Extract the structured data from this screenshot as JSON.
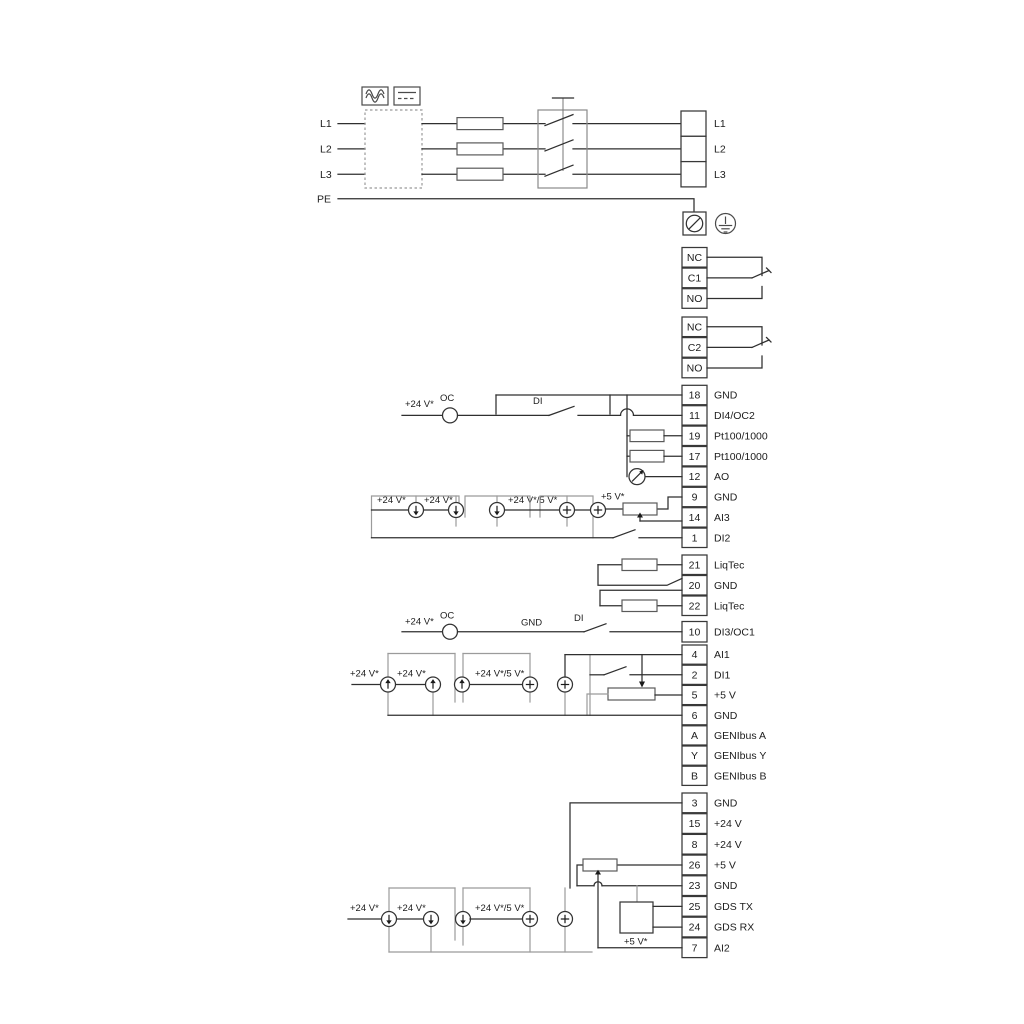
{
  "power": {
    "in": [
      "L1",
      "L2",
      "L3",
      "PE"
    ],
    "out": [
      "L1",
      "L2",
      "L3"
    ]
  },
  "relay1": [
    "NC",
    "C1",
    "NO"
  ],
  "relay2": [
    "NC",
    "C2",
    "NO"
  ],
  "io1": [
    {
      "n": "18",
      "l": "GND"
    },
    {
      "n": "11",
      "l": "DI4/OC2"
    },
    {
      "n": "19",
      "l": "Pt100/1000"
    },
    {
      "n": "17",
      "l": "Pt100/1000"
    },
    {
      "n": "12",
      "l": "AO"
    },
    {
      "n": "9",
      "l": "GND"
    },
    {
      "n": "14",
      "l": "AI3"
    },
    {
      "n": "1",
      "l": "DI2"
    }
  ],
  "liqtec": [
    {
      "n": "21",
      "l": "LiqTec"
    },
    {
      "n": "20",
      "l": "GND"
    },
    {
      "n": "22",
      "l": "LiqTec"
    }
  ],
  "io2": [
    {
      "n": "10",
      "l": "DI3/OC1"
    },
    {
      "n": "4",
      "l": "AI1"
    },
    {
      "n": "2",
      "l": "DI1"
    },
    {
      "n": "5",
      "l": "+5 V"
    },
    {
      "n": "6",
      "l": "GND"
    },
    {
      "n": "A",
      "l": "GENIbus A"
    },
    {
      "n": "Y",
      "l": "GENIbus Y"
    },
    {
      "n": "B",
      "l": "GENIbus B"
    }
  ],
  "io3": [
    {
      "n": "3",
      "l": "GND"
    },
    {
      "n": "15",
      "l": "+24 V"
    },
    {
      "n": "8",
      "l": "+24 V"
    },
    {
      "n": "26",
      "l": "+5 V"
    },
    {
      "n": "23",
      "l": "GND"
    },
    {
      "n": "25",
      "l": "GDS TX"
    },
    {
      "n": "24",
      "l": "GDS RX"
    },
    {
      "n": "7",
      "l": "AI2"
    }
  ],
  "ann": {
    "p24": "+24 V*",
    "p245": "+24 V*/5 V*",
    "p5": "+5 V*",
    "oc": "OC",
    "di": "DI",
    "gnd": "GND"
  },
  "colors": {
    "wire": "#2f2f2f",
    "frame": "#9b9b9b",
    "box_stroke": "#383838",
    "text": "#1c1c1c"
  }
}
